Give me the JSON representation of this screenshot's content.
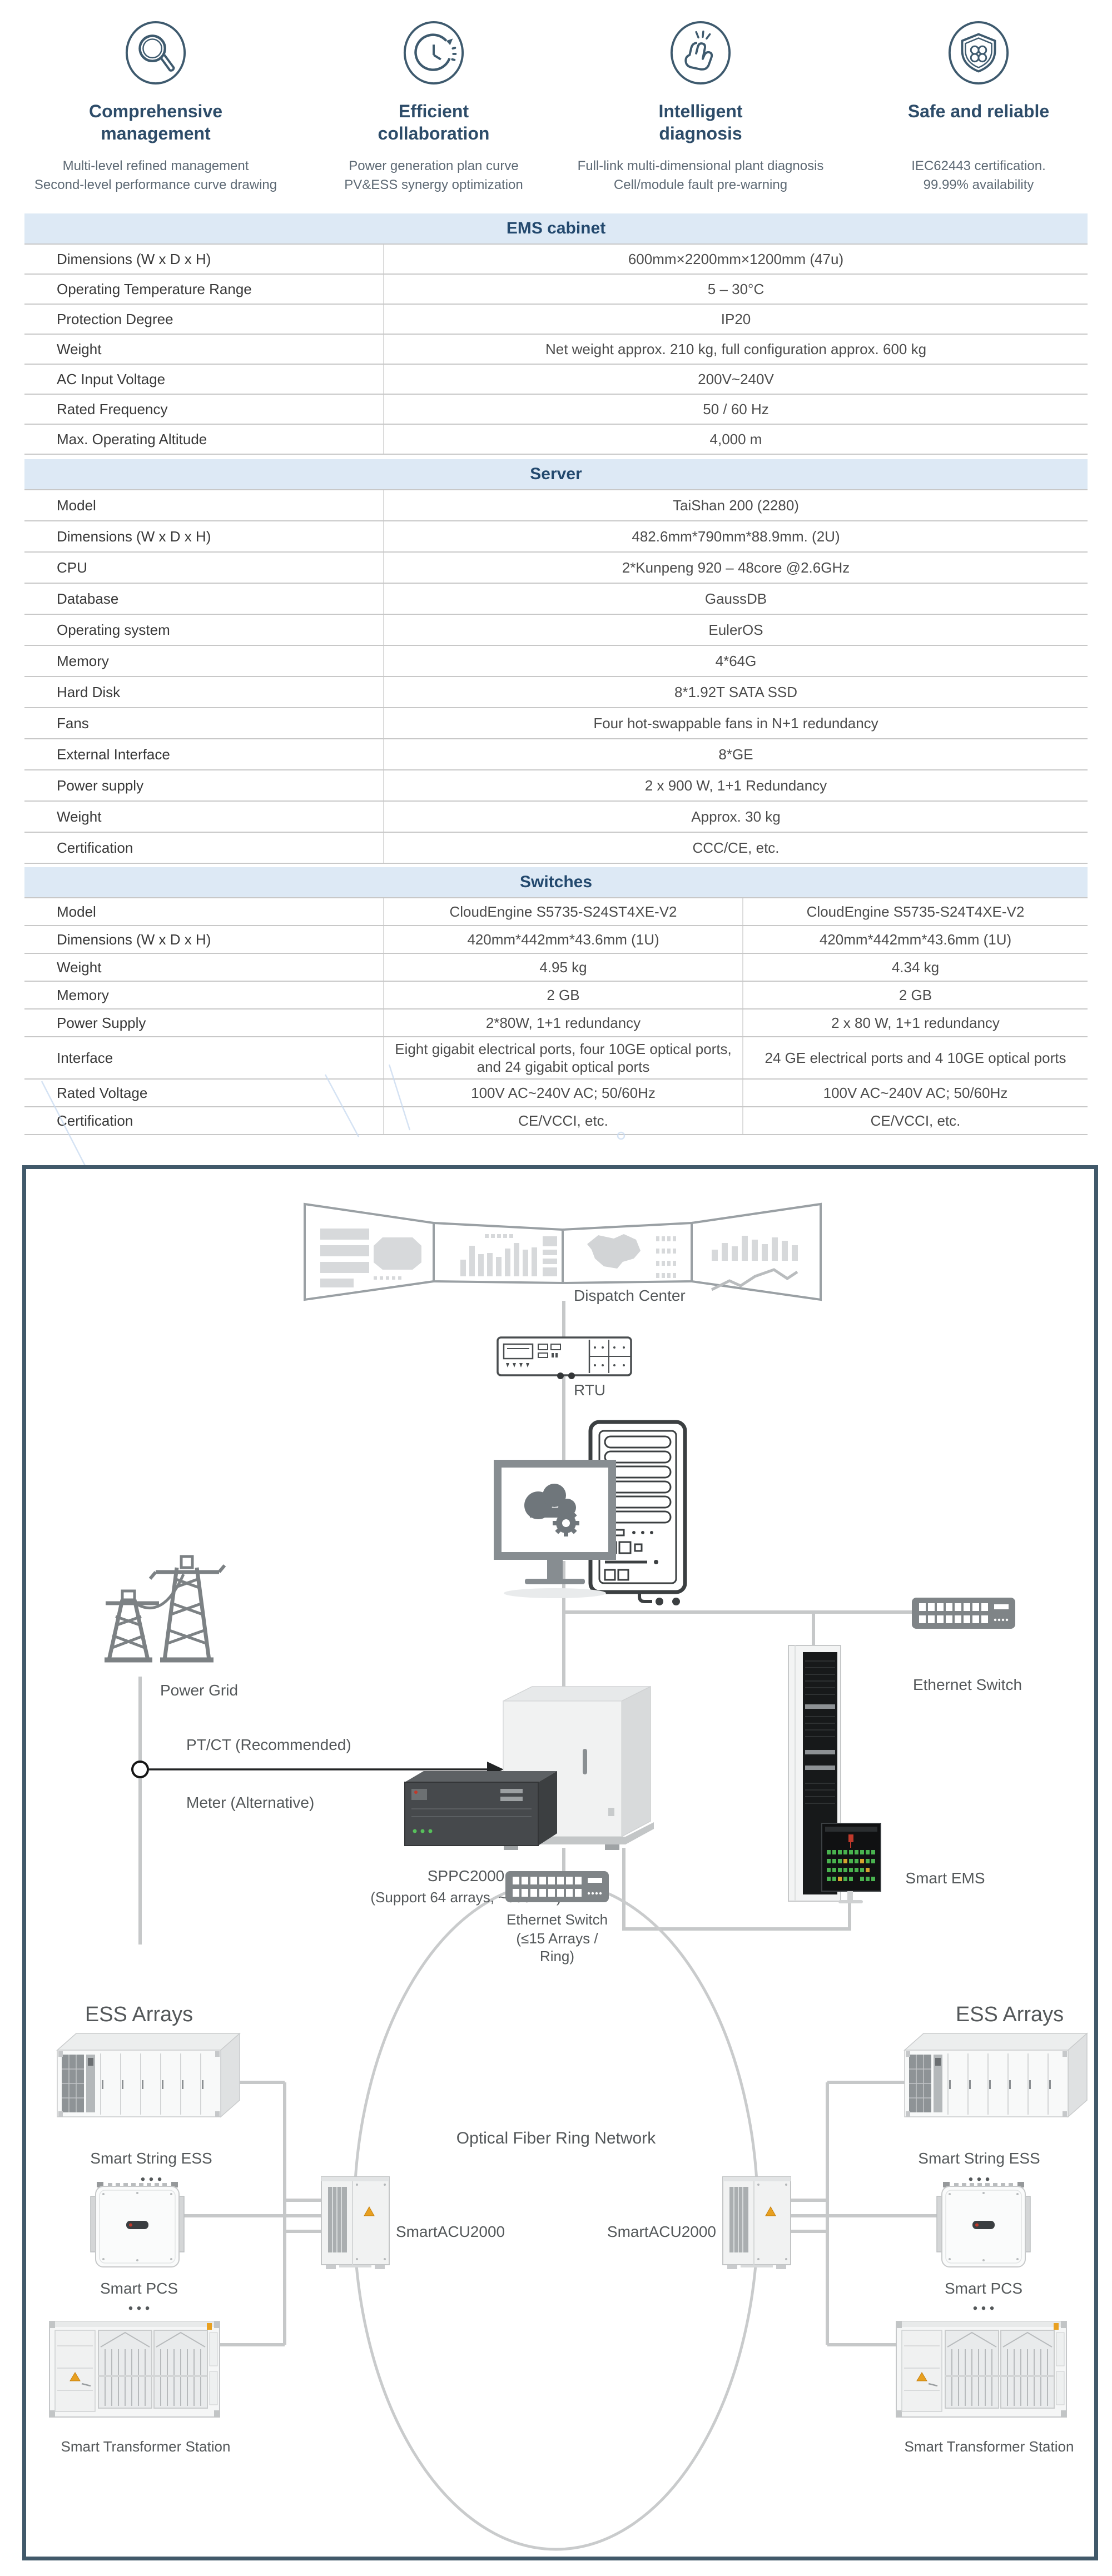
{
  "features": [
    {
      "icon": "magnifier-icon",
      "title_lines": [
        "Comprehensive",
        "management"
      ],
      "sub_lines": [
        "Multi-level refined management",
        "Second-level performance curve drawing"
      ]
    },
    {
      "icon": "clock-sync-icon",
      "title_lines": [
        "Efficient",
        "collaboration"
      ],
      "sub_lines": [
        "Power generation plan curve",
        "PV&ESS  synergy optimization"
      ]
    },
    {
      "icon": "snap-fingers-icon",
      "title_lines": [
        "Intelligent",
        "diagnosis"
      ],
      "sub_lines": [
        "Full-link multi-dimensional plant diagnosis",
        "Cell/module fault pre-warning"
      ]
    },
    {
      "icon": "shield-icon",
      "title_lines": [
        "Safe and reliable",
        ""
      ],
      "sub_lines": [
        "IEC62443 certification.",
        "99.99% availability"
      ]
    }
  ],
  "tables": [
    {
      "title": "EMS cabinet",
      "rows": [
        [
          "Dimensions (W x D x H)",
          "600mm×2200mm×1200mm (47u)"
        ],
        [
          "Operating Temperature Range",
          "5 – 30°C"
        ],
        [
          "Protection Degree",
          "IP20"
        ],
        [
          "Weight",
          "Net weight approx. 210 kg, full configuration approx. 600 kg"
        ],
        [
          "AC Input Voltage",
          "200V~240V"
        ],
        [
          "Rated Frequency",
          "50 / 60 Hz"
        ],
        [
          "Max. Operating Altitude",
          "4,000 m"
        ]
      ]
    },
    {
      "title": "Server",
      "rows": [
        [
          "Model",
          "TaiShan 200 (2280)"
        ],
        [
          "Dimensions (W x D x H)",
          "482.6mm*790mm*88.9mm. (2U)"
        ],
        [
          "CPU",
          "2*Kunpeng 920 – 48core @2.6GHz"
        ],
        [
          "Database",
          "GaussDB"
        ],
        [
          "Operating system",
          "EulerOS"
        ],
        [
          "Memory",
          "4*64G"
        ],
        [
          "Hard Disk",
          "8*1.92T SATA SSD"
        ],
        [
          "Fans",
          "Four hot-swappable fans in N+1 redundancy"
        ],
        [
          "External Interface",
          "8*GE"
        ],
        [
          "Power supply",
          "2 x 900 W, 1+1 Redundancy"
        ],
        [
          "Weight",
          "Approx. 30 kg"
        ],
        [
          "Certification",
          "CCC/CE, etc."
        ]
      ]
    },
    {
      "title": "Switches",
      "rows": [
        [
          "Model",
          "CloudEngine S5735-S24ST4XE-V2",
          "CloudEngine S5735-S24T4XE-V2"
        ],
        [
          "Dimensions (W x D x H)",
          "420mm*442mm*43.6mm (1U)",
          "420mm*442mm*43.6mm (1U)"
        ],
        [
          "Weight",
          "4.95 kg",
          "4.34 kg"
        ],
        [
          "Memory",
          "2 GB",
          "2 GB"
        ],
        [
          "Power Supply",
          "2*80W, 1+1 redundancy",
          "2 x 80 W, 1+1 redundancy"
        ],
        [
          "Interface",
          "Eight gigabit electrical ports, four 10GE optical ports, and 24 gigabit optical ports",
          "24 GE electrical ports and 4 10GE optical ports"
        ],
        [
          "Rated Voltage",
          "100V AC~240V AC; 50/60Hz",
          "100V AC~240V AC; 50/60Hz"
        ],
        [
          "Certification",
          "CE/VCCI, etc.",
          "CE/VCCI, etc."
        ]
      ]
    }
  ],
  "diagram": {
    "dispatch_center": "Dispatch Center",
    "rtu": "RTU",
    "ethernet_switch_top": "Ethernet Switch",
    "smart_ems": "Smart EMS",
    "power_grid": "Power Grid",
    "ptct": "PT/CT (Recommended)",
    "meter": "Meter (Alternative)",
    "sppc": "SPPC2000",
    "sppc_sub": "(Support 64 arrays, ~500MW)",
    "ethernet_switch_mid_1": "Ethernet Switch",
    "ethernet_switch_mid_2": "(≤15 Arrays /",
    "ethernet_switch_mid_3": "Ring)",
    "ring": "Optical Fiber Ring Network",
    "acu_left": "SmartACU2000",
    "acu_right": "SmartACU2000",
    "ess_arrays_left": "ESS Arrays",
    "ess_arrays_right": "ESS Arrays",
    "string_ess_left": "Smart String ESS",
    "string_ess_right": "Smart String ESS",
    "pcs_left": "Smart PCS",
    "pcs_right": "Smart PCS",
    "transformer_left": "Smart Transformer Station",
    "transformer_right": "Smart Transformer Station",
    "dots": "• • •"
  },
  "colors": {
    "accent_navy": "#2d4c69",
    "table_header_bg": "#dde9f5",
    "table_header_text": "#23496e",
    "label_text": "#393939",
    "value_text": "#4c4c4c",
    "diagram_border": "#41596a",
    "diagram_line": "#c6c8c9",
    "icon_stroke": "#3e5a6e"
  }
}
